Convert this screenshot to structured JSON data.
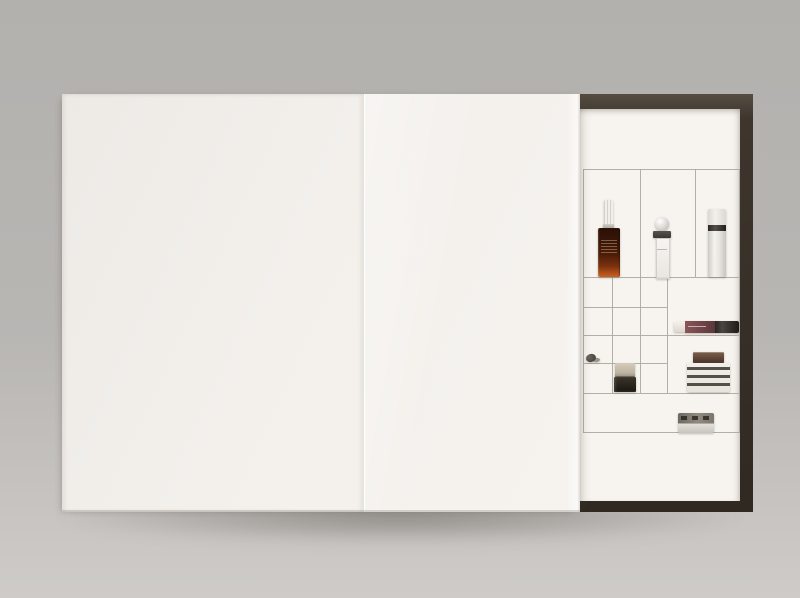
{
  "scene": {
    "description": "Product photograph: large white slide-lid gift box (beauty advent-calendar style) on a grey studio backdrop; lid slid left revealing a dark-framed interior with a grid of white compartments holding mini cosmetics",
    "text_visible": "none (no legible text in image)"
  },
  "theme": {
    "bg_top": "#b3b1ae",
    "bg_mid": "#b8b6b3",
    "bg_bottom": "#cecbc8",
    "lid": "#f3f0ec",
    "interior": "#f7f4f0",
    "frame": "#3e362d",
    "frame_light": "#554c42",
    "frame_dark": "#2f2922",
    "grid_line": "#aea89f",
    "serum_top": "#2a1007",
    "serum_glow": "#b8541a",
    "perfume_collar": "#3a3631",
    "pump_band": "#544f48",
    "trinket": "#4b4640",
    "jar_cap": "#bdb3a1",
    "jar_base": "#211c16",
    "gloss_liquid": "#6e4348",
    "gloss_cap": "#1e1a18",
    "cream_cap": "#4f382c",
    "tin_top": "#908a80",
    "tin_base": "#c8c4be"
  },
  "box": {
    "lid_panels": 2,
    "compartment_layout": {
      "tall_top_row_cells": 3,
      "small_square_grid": {
        "rows": 4,
        "cols": 3
      },
      "right_wide_cells": 2,
      "bottom_full_width_cells": 1
    }
  },
  "products": [
    {
      "name": "amber-serum-dropper-bottle",
      "description": "dark amber glass serum with white ribbed dropper cap, glowing orange base, illegible micro-label"
    },
    {
      "name": "mini-perfume-bottle",
      "description": "tiny clear flacon with spherical frosted cap and dark collar, faint script on glass"
    },
    {
      "name": "airless-pump-bottle",
      "description": "slim white cylinder with dark band below translucent cap"
    },
    {
      "name": "shell-trinket",
      "description": "small dark shell-shaped piece lying in a square compartment"
    },
    {
      "name": "mini-glass-jar",
      "description": "small dark glass jar with tan/beige cap"
    },
    {
      "name": "lip-gloss-tube",
      "description": "gloss lying on its side: white tip, mauve-burgundy barrel, dark cap"
    },
    {
      "name": "striped-cream-jar",
      "description": "white jar with dark horizontal label stripes and bronze-brown lid"
    },
    {
      "name": "round-balm-tin",
      "description": "flat round tin seen edge-on, marked dark upper rim and pale base"
    }
  ]
}
